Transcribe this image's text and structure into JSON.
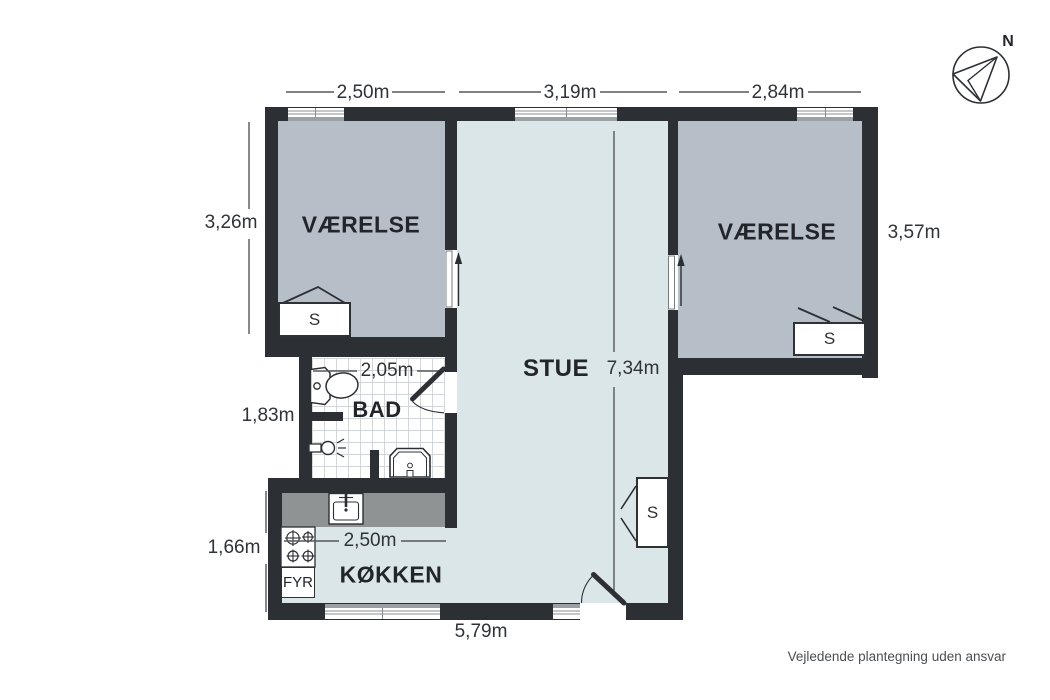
{
  "rooms": {
    "bedroom_left": "VÆRELSE",
    "bedroom_right": "VÆRELSE",
    "living_room": "STUE",
    "bathroom": "BAD",
    "kitchen": "KØKKEN",
    "furnace": "FYR"
  },
  "dimensions": {
    "bedroom_left_width": "2,50m",
    "living_width": "3,19m",
    "bedroom_right_width": "2,84m",
    "bedroom_left_depth": "3,26m",
    "bathroom_depth": "1,83m",
    "kitchen_depth": "1,66m",
    "bedroom_right_depth": "3,57m",
    "bathroom_width": "2,05m",
    "kitchen_width": "2,50m",
    "living_depth": "7,34m",
    "building_bottom_width": "5,79m"
  },
  "markers": {
    "closet": "S",
    "compass_north": "N"
  },
  "footer": {
    "disclaimer": "Vejledende plantegning uden ansvar"
  },
  "colors": {
    "wall": "#2c3034",
    "bedroom_floor": "#b6bfc8",
    "living_floor": "#dae6e7",
    "counter": "#909394",
    "sill": "#9aa0a3",
    "dim_text": "#2f3337",
    "room_text": "#22262a",
    "muted_text": "#4b4f53"
  }
}
